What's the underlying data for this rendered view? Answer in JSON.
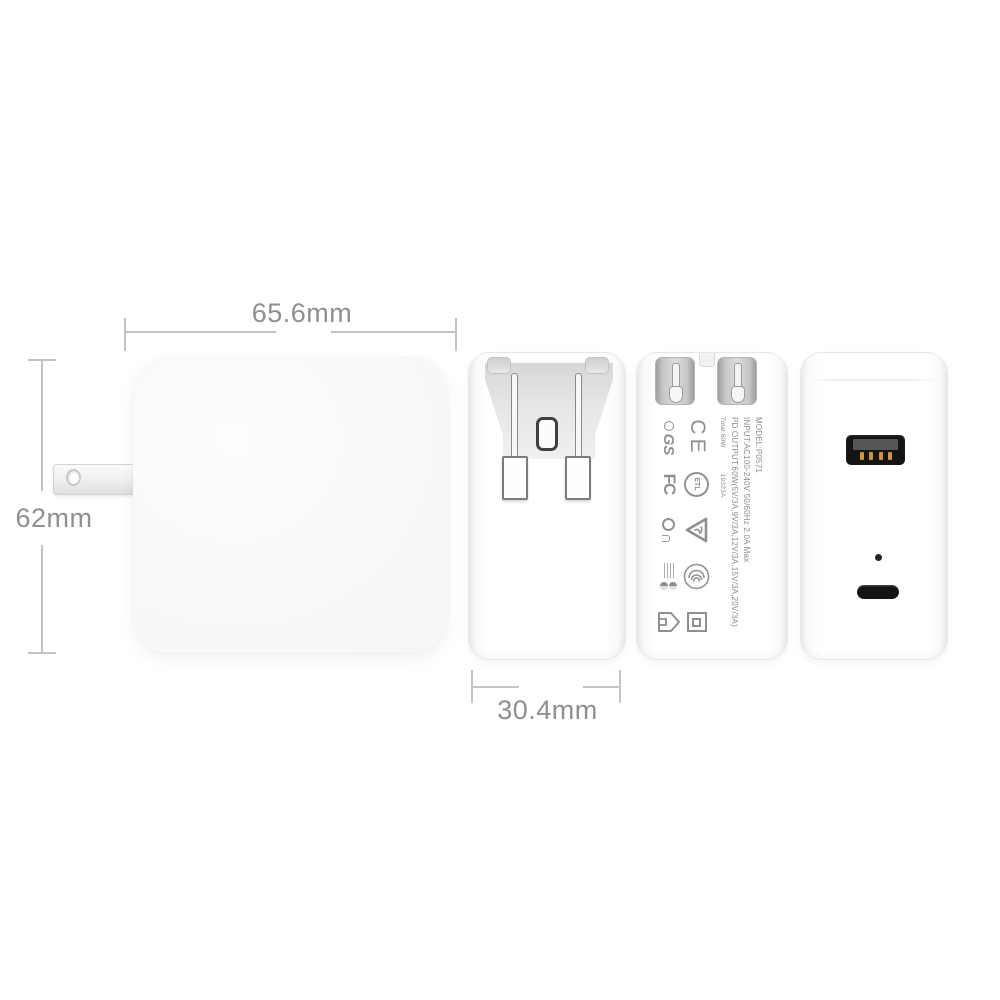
{
  "dimensions": {
    "width_label": "65.6mm",
    "height_label": "62mm",
    "depth_label": "30.4mm"
  },
  "spec_label": {
    "model": "MODEL:P0571",
    "input": "INPUT:AC100-240V 50/60Hz 2.0A Max",
    "output": "PD OUTPUT:60W(5V/3A,9V/3A,12V/3A,15V/3A,20V/3A)",
    "total": "Total 60W",
    "batch_code": "19323A"
  },
  "certification_marks": {
    "ce": "CE",
    "fcc": "FC",
    "gs": "GS",
    "etl": "ETL",
    "icons": [
      "tuv-gs-mark",
      "ce-mark",
      "fcc-mark",
      "etl-mark",
      "rcm-circle-mark",
      "cqc-triangle-mark",
      "ccc-mark",
      "efficiency-fineprint-mark",
      "indoor-use-house-icon",
      "class-ii-double-insulation-icon"
    ]
  },
  "ports": {
    "icons": [
      "usb-a-port",
      "usb-c-port",
      "led-indicator",
      "plug-prong",
      "folded-prongs"
    ]
  },
  "colors": {
    "background": "#ffffff",
    "dimension_text": "#8f8f8f",
    "dimension_line": "#c3c3c3",
    "body_white": "#fafafa",
    "label_text": "#8a8a8a",
    "port_black": "#141414",
    "usb_pins_orange": "#cf9436"
  }
}
